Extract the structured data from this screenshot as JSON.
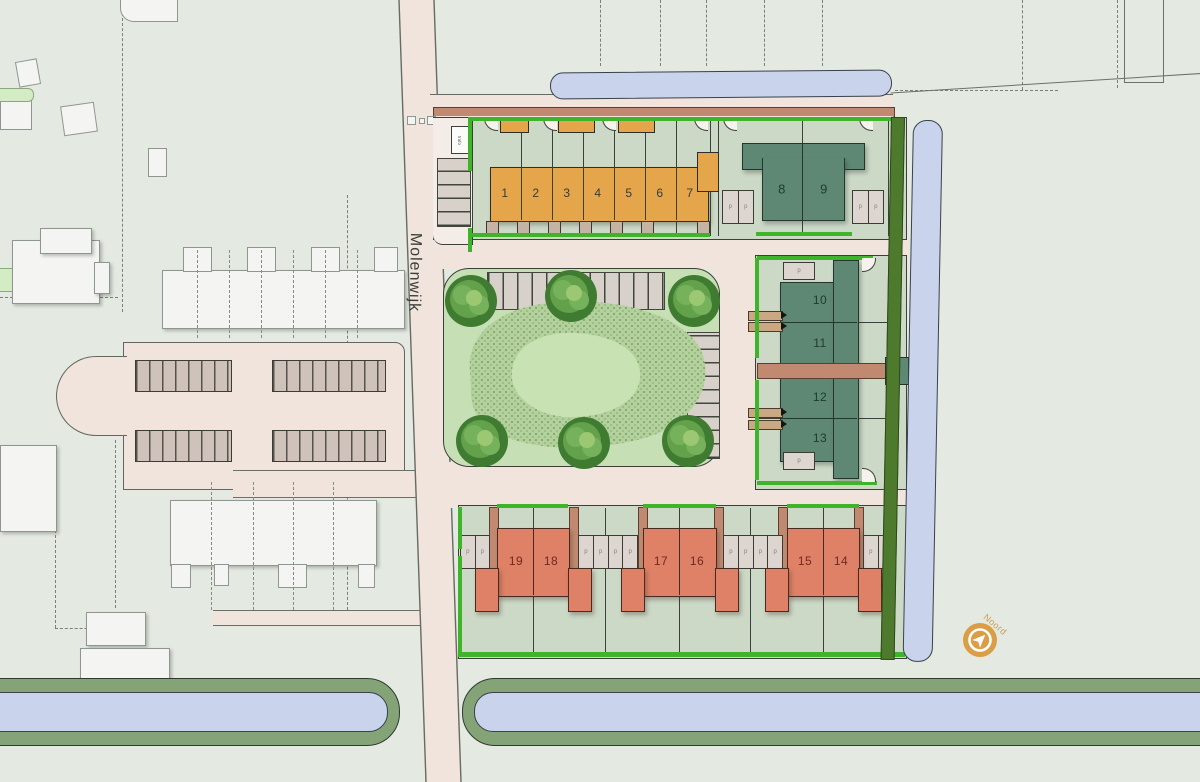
{
  "street_label": "Molenwijk",
  "compass": {
    "label": "Noord"
  },
  "labels": {
    "parking": "p",
    "transformer": "trafo"
  },
  "plots": {
    "terraced_row": [
      "1",
      "2",
      "3",
      "4",
      "5",
      "6",
      "7"
    ],
    "twin_north": [
      "8",
      "9"
    ],
    "east_column": [
      "10",
      "11",
      "12",
      "13"
    ],
    "south_pairs": [
      "19",
      "18",
      "17",
      "16",
      "15",
      "14"
    ]
  },
  "colors": {
    "background": "#e4e9e1",
    "garden": "#ccd9c7",
    "road": "#f0e4dd",
    "boundary_green": "#3fb42a",
    "hedge_green": "#4e7a2e",
    "water": "#c9d3ec",
    "bank_green": "#84a477",
    "house_orange": "#e5a54b",
    "house_teal": "#5e8874",
    "house_salmon": "#df8166",
    "path_brown": "#c18a70",
    "park_green": "#c7dfb5",
    "compass_orange": "#db9d45"
  }
}
